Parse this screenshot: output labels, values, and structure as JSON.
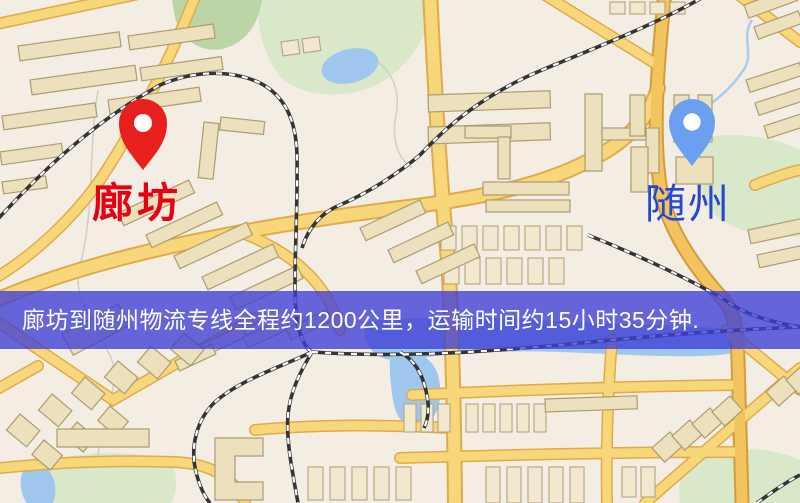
{
  "banner": {
    "text": "廊坊到随州物流专线全程约1200公里，运输时间约15小时35分钟.",
    "background_color": "#3e3ed6",
    "text_color": "#ffffff"
  },
  "markers": {
    "origin": {
      "name": "廊坊",
      "pin_color": "#e8201d",
      "label_color": "#e60012"
    },
    "destination": {
      "name": "随州",
      "pin_color": "#6b9ff0",
      "label_color": "#2746d6"
    }
  },
  "map_palette": {
    "background": "#f4ede3",
    "road_minor": "#f8d77a",
    "road_major": "#f3c45e",
    "building": "#ece0bd",
    "water": "#9fc6ee",
    "park_green": "#d9e8c9",
    "railway": "#343434"
  }
}
